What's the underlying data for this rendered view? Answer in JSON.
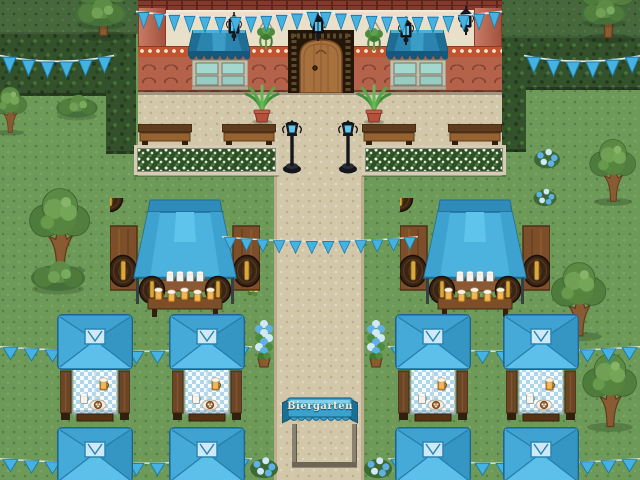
{
  "sign": {
    "label": "Biergarten"
  },
  "palette": {
    "grass": "#6d9a58",
    "grass-dark": "#46683c",
    "hedge": "#33512b",
    "path": "#d2c7a9",
    "wall-cream": "#eadfc8",
    "terracotta": "#b5624a",
    "brick": "#83392c",
    "accent-blue": "#45b2e2",
    "awning-blue": "#2a84ad",
    "tent-blue": "#4cb2de",
    "wood": "#7c4e2a",
    "wood-dark": "#4a2c15"
  }
}
